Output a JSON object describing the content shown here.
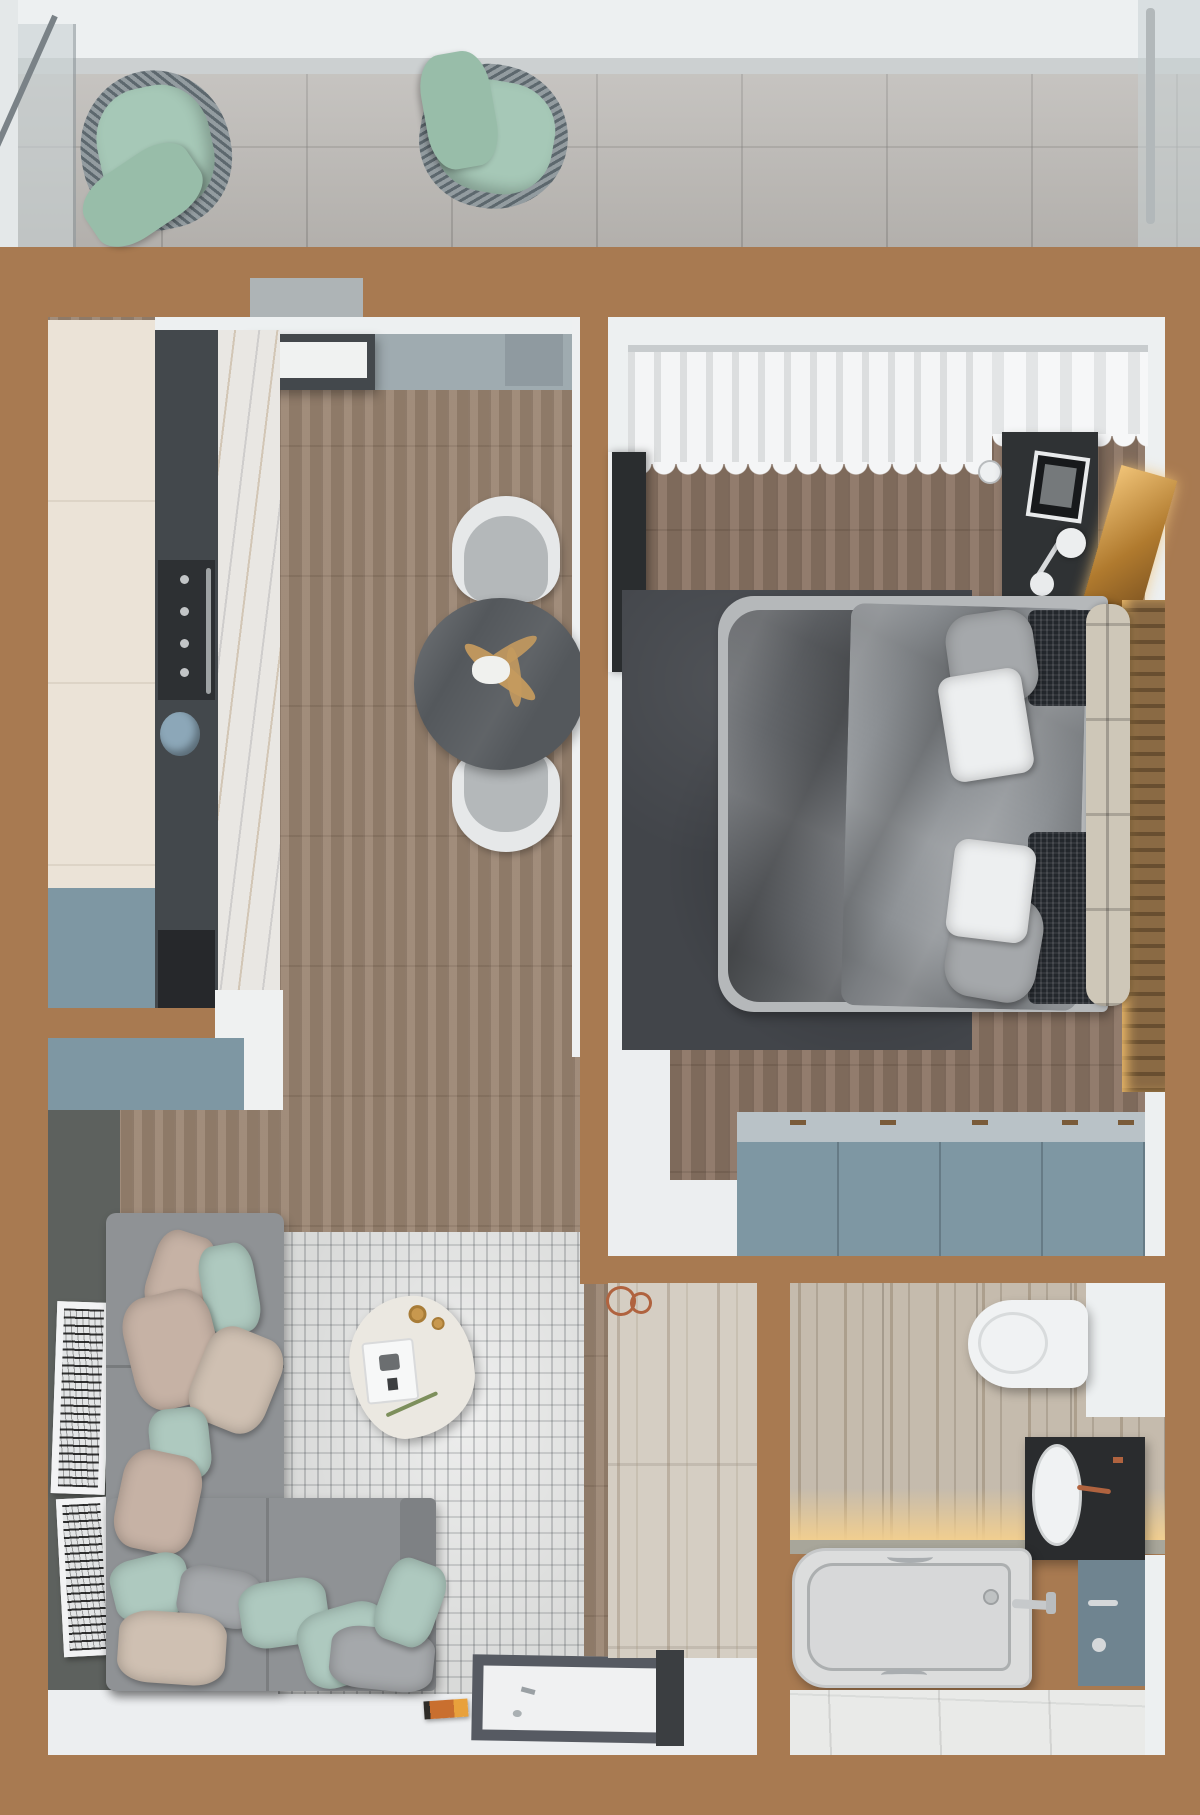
{
  "scene": {
    "type": "apartment-floor-plan-3d-render",
    "view": "top-down",
    "rooms": [
      {
        "name": "balcony",
        "objects": [
          "glass-railing",
          "outdoor-chair-left",
          "outdoor-chair-right",
          "tile-floor"
        ]
      },
      {
        "name": "kitchen-living-room",
        "objects": [
          "tall-cream-cabinets",
          "oven",
          "cooktop",
          "marble-backsplash",
          "range-hood",
          "blue-base-cabinets",
          "white-countertop",
          "round-dining-table",
          "dining-chair-top",
          "dining-chair-bottom",
          "corner-sofa",
          "throw-pillows",
          "distressed-rug",
          "organic-coffee-table",
          "wall-art-frames",
          "doormat",
          "magazine"
        ]
      },
      {
        "name": "bedroom",
        "objects": [
          "open-wardrobe-hanging-clothes",
          "curtain",
          "tv-panel",
          "desk",
          "laptop",
          "desk-lamp",
          "wall-clock",
          "double-bed",
          "dark-duvet",
          "white-pillows",
          "knit-throw",
          "champagne-headboard",
          "charcoal-rug",
          "gold-leaning-mirror",
          "slatted-radiator-panel",
          "blue-dresser"
        ]
      },
      {
        "name": "hallway",
        "objects": [
          "marble-tile-floor",
          "wire-basket",
          "console-edge"
        ]
      },
      {
        "name": "bathroom",
        "objects": [
          "travertine-wall-tile",
          "led-cove-light",
          "wall-hung-toilet",
          "black-vanity",
          "oval-sink",
          "copper-faucet",
          "teal-counter",
          "bathtub",
          "chrome-handles",
          "marble-floor"
        ]
      }
    ]
  },
  "colors": {
    "wall_brown": "#a87a51",
    "trim_white": "#edf0f1",
    "balcony_tile": "#bcb9b5",
    "glass": "#c9d2d4",
    "chair_mint": "#a6c8b7",
    "chair_mint_dark": "#98bda9",
    "wicker_gray": "#6d777c",
    "floor_wood_living": "#9a8471",
    "floor_wood_bedroom": "#8b7464",
    "floor_white": "#eceef0",
    "hall_marble": "#d5cec3",
    "cabinet_cream": "#ebe3d7",
    "cabinet_blue": "#7e97a3",
    "dresser_top": "#b9c2c7",
    "counter_white": "#eff1f1",
    "marble_backsplash": "#e9e7e3",
    "appliance_dark": "#43484c",
    "oven_black": "#2d3033",
    "cooktop_black": "#26282b",
    "kettle_blue": "#8ca7b8",
    "band_gray": "#9fabb0",
    "ac_gray": "#8f9aa0",
    "table_dark": "#54585c",
    "chair_shell": "#e6e8e9",
    "chair_cushion": "#b4b8ba",
    "plant_tan": "#c49a5e",
    "sofa_gray": "#8f9295",
    "sofa_arm": "#7e8184",
    "pillow_mint": "#aec9bf",
    "pillow_blush": "#c6b2a5",
    "pillow_beige": "#cfc0b2",
    "pillow_gray": "#a5a8ab",
    "pillow_white": "#edeff0",
    "rug_living": "#d9dad9",
    "wall_dark": "#5d615e",
    "coffee_table": "#ebe8e1",
    "gold": "#c8984e",
    "rug_bedroom": "#42454a",
    "bed_frame": "#b5b8ba",
    "bed_duvet": "#63666a",
    "bed_sheet": "#8e9296",
    "knit_dark": "#23272c",
    "headboard": "#cec7b8",
    "desk_dark": "#2f3234",
    "radiator_brown": "#8a6a44",
    "bath_wall": "#c5bbad",
    "bath_floor": "#e9eae8",
    "tub_white": "#dcdddd",
    "vanity_dark": "#2a2c2e",
    "counter_teal": "#6f8490",
    "toilet_white": "#f0f2f3",
    "led_glow": "#f3cf8e",
    "book_orange": "#d07a2e",
    "copper": "#b0633f",
    "rail_gray": "#c8ccce"
  }
}
